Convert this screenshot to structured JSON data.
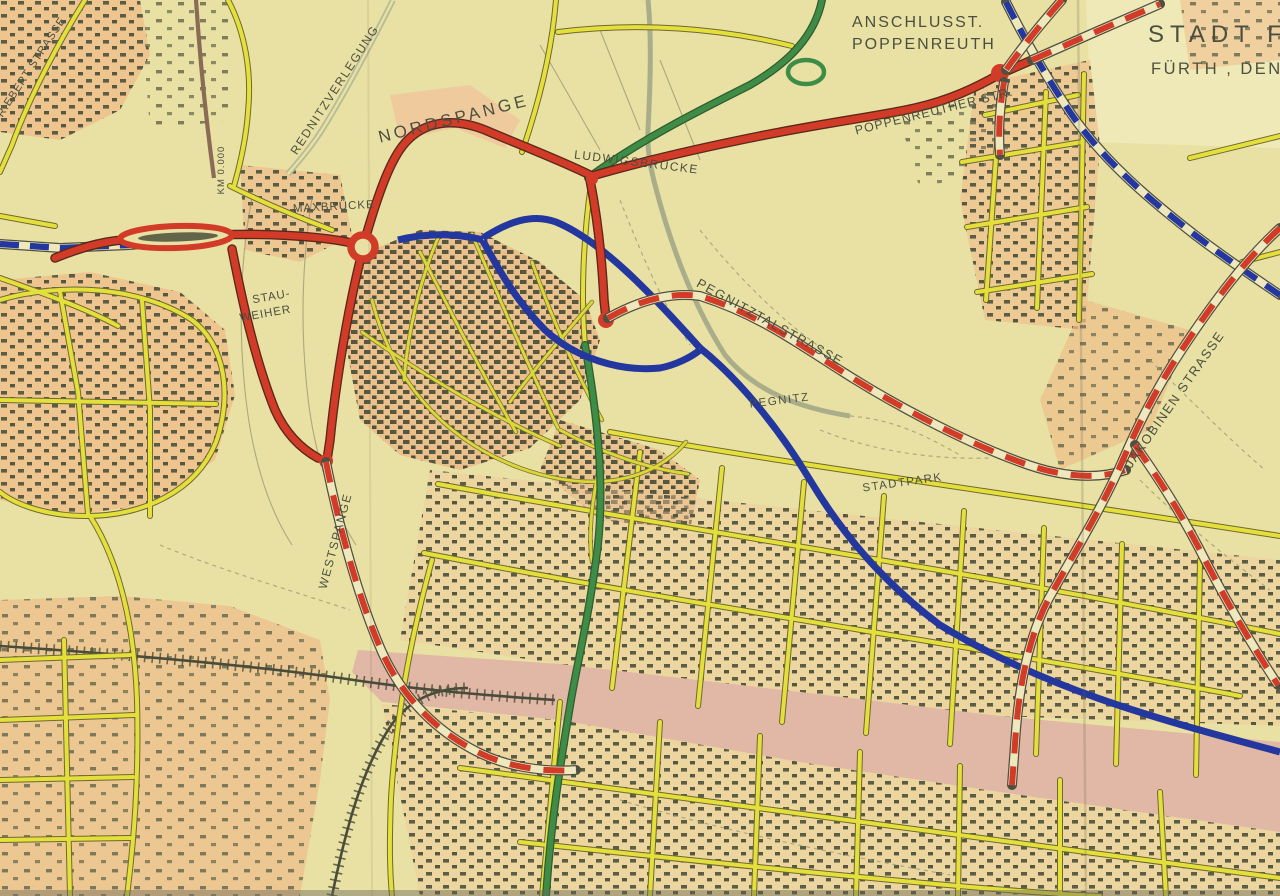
{
  "map": {
    "title_block": {
      "line1": "STADT FÜ",
      "line2": "FÜRTH , DEN"
    },
    "labels": {
      "anschluss_line1": {
        "text": "ANSCHLUSST."
      },
      "anschluss_line2": {
        "text": "POPPENREUTH"
      },
      "nordspange": {
        "text": "NORDSPANGE"
      },
      "ludwigsbruecke": {
        "text": "LUDWIGSBRÜCKE"
      },
      "poppenreuther_str": {
        "text": "POPPENREUTHER STR."
      },
      "rednitzverlegung": {
        "text": "REDNITZVERLEGUNG"
      },
      "fr_ebert_strasse": {
        "text": "FR.EBERT STRASSE"
      },
      "km_mark": {
        "text": "KM 0.000"
      },
      "maxbruecke": {
        "text": "MAXBRÜCKE"
      },
      "stauweiher_line1": {
        "text": "STAU-"
      },
      "stauweiher_line2": {
        "text": "WEIHER"
      },
      "pegnitztalstrasse": {
        "text": "PEGNITZTALSTRASSE"
      },
      "pegnitz": {
        "text": "PEGNITZ"
      },
      "stadtpark": {
        "text": "STADTPARK"
      },
      "jakobinen_strasse": {
        "text": "JAKOBINEN STRASSE"
      },
      "westspange": {
        "text": "WESTSPANGE"
      }
    },
    "colors": {
      "paper": "#e9e1a3",
      "title_panel": "#efe9b8",
      "road_red": "#d23b28",
      "road_yellow": "#e4df3b",
      "road_green": "#3e8c46",
      "route_blue": "#23379f",
      "rail_corridor_pink": "#e0b3a6",
      "residential_orange": "#eec08c",
      "building_olive": "#55573f",
      "label_ink": "#4b4f40"
    }
  }
}
